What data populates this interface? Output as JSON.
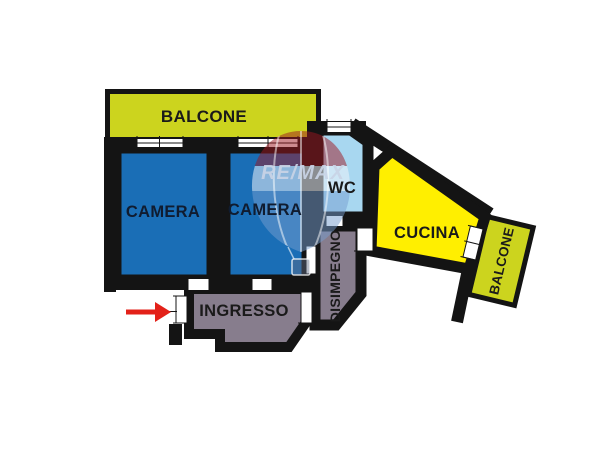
{
  "background": "#ffffff",
  "wall_color": "#141414",
  "watermark": {
    "text": "RE/MAX",
    "symbol": "hot-air-balloon",
    "text_color": "#c9d4e6"
  },
  "entrance_arrow": {
    "direction": "right",
    "color": "#e32119"
  },
  "rooms": [
    {
      "id": "balcone-top",
      "label": "BALCONE",
      "fill": "#ccd41e"
    },
    {
      "id": "camera-1",
      "label": "CAMERA",
      "fill": "#1a6eb6"
    },
    {
      "id": "camera-2",
      "label": "CAMERA",
      "fill": "#1a6eb6"
    },
    {
      "id": "wc",
      "label": "WC",
      "fill": "#a8d7f0"
    },
    {
      "id": "disimpegno",
      "label": "DISIMPEGNO",
      "fill": "#877d8d"
    },
    {
      "id": "cucina",
      "label": "CUCINA",
      "fill": "#ffef00"
    },
    {
      "id": "ingresso",
      "label": "INGRESSO",
      "fill": "#877d8d"
    },
    {
      "id": "balcone-right",
      "label": "BALCONE",
      "fill": "#ccd41e"
    }
  ]
}
